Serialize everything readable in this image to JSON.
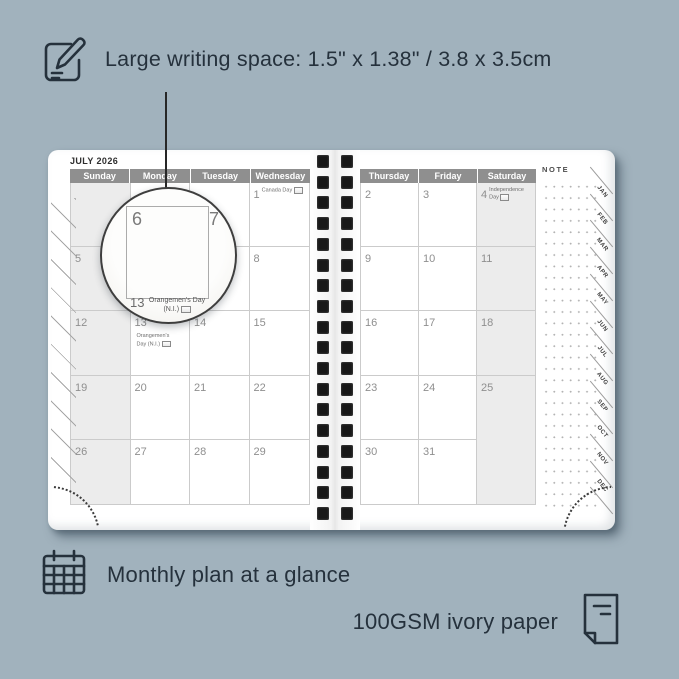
{
  "colors": {
    "background": "#a1b2bd",
    "accent_text": "#25313c",
    "day_header_bg": "#8f8f8f",
    "weekend_cell_bg": "#ececec",
    "grid_line": "#cbcbcb",
    "binding_hole": "#181818"
  },
  "top_feature": {
    "icon": "pencil-note-icon",
    "text": "Large writing space: 1.5\" x 1.38\" / 3.8 x 3.5cm"
  },
  "planner": {
    "month_title": "JULY 2026",
    "left_day_headers": [
      "Sunday",
      "Monday",
      "Tuesday",
      "Wednesday"
    ],
    "right_day_headers": [
      "Thursday",
      "Friday",
      "Saturday"
    ],
    "note_label": "NOTE",
    "month_tabs": [
      "JAN",
      "FEB",
      "MAR",
      "APR",
      "MAY",
      "JUN",
      "JUL",
      "AUG",
      "SEP",
      "OCT",
      "NOV",
      "DEC"
    ],
    "left_grid": [
      [
        {
          "date": ""
        },
        {
          "date": ""
        },
        {
          "date": ""
        },
        {
          "date": "1",
          "holiday": "Canada Day",
          "flag": true
        }
      ],
      [
        {
          "date": "5"
        },
        {
          "date": "6"
        },
        {
          "date": "7"
        },
        {
          "date": "8"
        }
      ],
      [
        {
          "date": "12"
        },
        {
          "date": "13",
          "holiday": "Orangemen's Day (N.I.)",
          "flag": true
        },
        {
          "date": "14"
        },
        {
          "date": "15"
        }
      ],
      [
        {
          "date": "19"
        },
        {
          "date": "20"
        },
        {
          "date": "21"
        },
        {
          "date": "22"
        }
      ],
      [
        {
          "date": "26"
        },
        {
          "date": "27"
        },
        {
          "date": "28"
        },
        {
          "date": "29"
        }
      ]
    ],
    "right_grid": [
      [
        {
          "date": "2"
        },
        {
          "date": "3"
        },
        {
          "date": "4",
          "holiday": "Independence Day",
          "flag": true
        }
      ],
      [
        {
          "date": "9"
        },
        {
          "date": "10"
        },
        {
          "date": "11"
        }
      ],
      [
        {
          "date": "16"
        },
        {
          "date": "17"
        },
        {
          "date": "18"
        }
      ],
      [
        {
          "date": "23"
        },
        {
          "date": "24"
        },
        {
          "date": "25"
        }
      ],
      [
        {
          "date": "30"
        },
        {
          "date": "31"
        },
        {
          "date": ""
        }
      ]
    ]
  },
  "magnifier": {
    "left_date": "6",
    "right_date": "7",
    "bottom_date": "13",
    "bottom_holiday": "Orangemen's Day",
    "bottom_holiday_line2": "(N.I.)"
  },
  "bottom_features": [
    {
      "icon": "calendar-grid-icon",
      "text": "Monthly plan at a glance"
    },
    {
      "icon": "paper-icon",
      "text": "100GSM ivory paper"
    }
  ]
}
